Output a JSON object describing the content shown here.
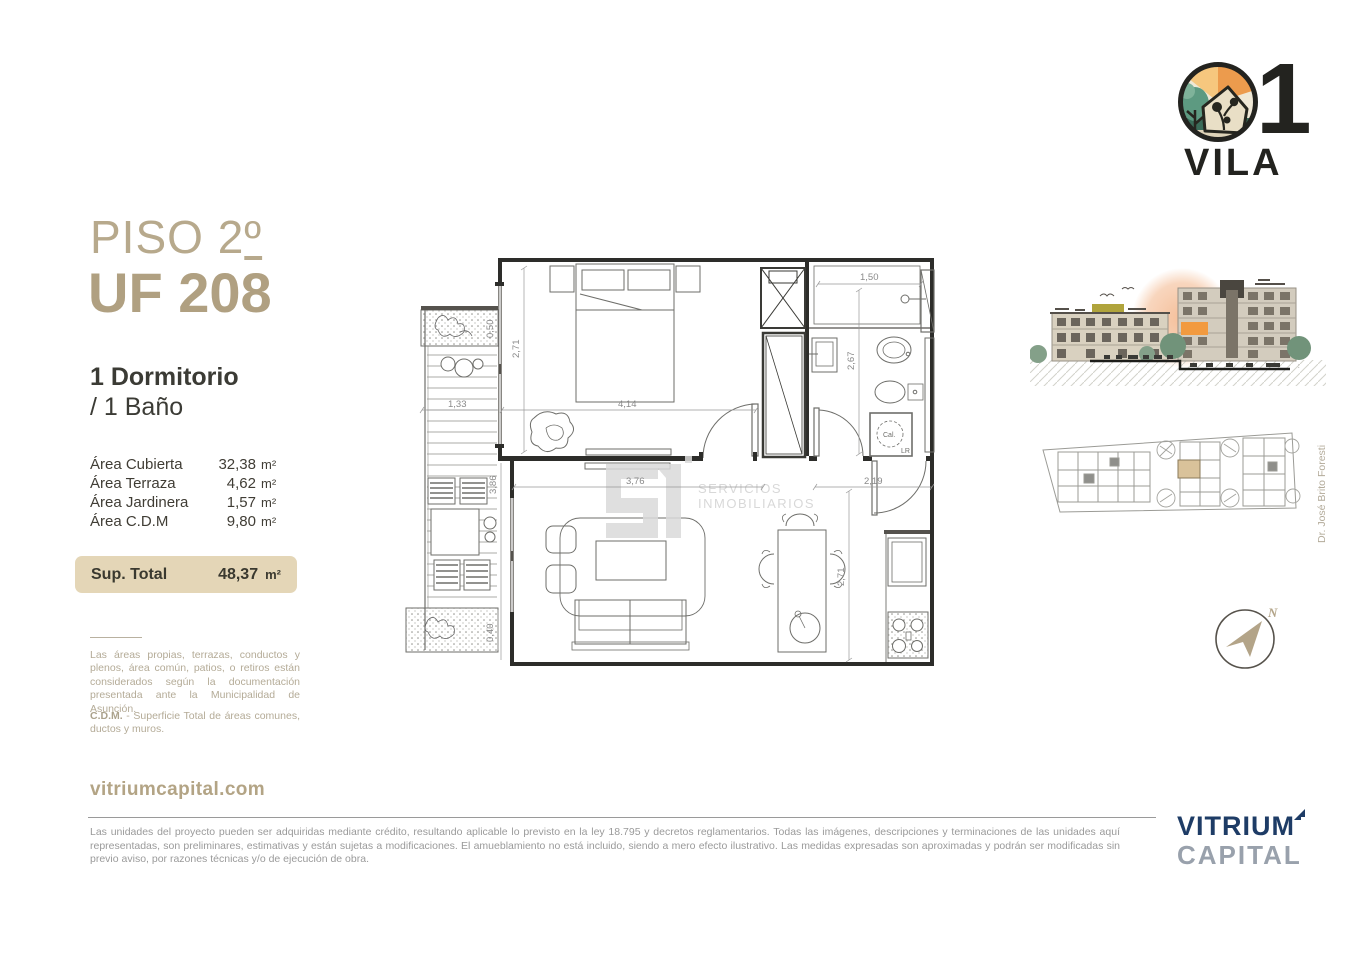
{
  "brand": {
    "number": "1",
    "name": "VILA"
  },
  "unit": {
    "floor_prefix": "PISO 2",
    "floor_ordinal": "º",
    "unit_code": "UF 208",
    "bedrooms": "1 Dormitorio",
    "bathrooms": "/ 1 Baño"
  },
  "areas": {
    "rows": [
      {
        "label": "Área Cubierta",
        "value": "32,38",
        "unit": "m²"
      },
      {
        "label": "Área Terraza",
        "value": "4,62",
        "unit": "m²"
      },
      {
        "label": "Área Jardinera",
        "value": "1,57",
        "unit": "m²"
      },
      {
        "label": "Área C.D.M",
        "value": "9,80",
        "unit": "m²"
      }
    ],
    "total_label": "Sup. Total",
    "total_value": "48,37",
    "total_unit": "m²"
  },
  "notes": {
    "general": "Las áreas propias, terrazas, conductos y plenos, área común, patios, o retiros están considerados según la documentación presentada ante la Municipalidad de Asunción.",
    "cdm_term": "C.D.M.",
    "cdm_definition": " - Superficie Total de áreas comunes, ductos y muros."
  },
  "website": "vitriumcapital.com",
  "footer": {
    "disclaimer": "Las unidades del proyecto pueden ser adquiridas mediante crédito, resultando aplicable lo previsto en la ley 18.795 y decretos reglamentarios. Todas las imágenes, descripciones y terminaciones de las unidades aquí representadas, son preliminares, estimativas y están sujetas a modificaciones. El amueblamiento no está incluido, siendo a mero efecto ilustrativo. Las medidas expresadas son aproximadas y podrán ser modificadas sin previo aviso, por razones técnicas y/o de ejecución de obra.",
    "brand_top": "VITRIUM",
    "brand_bottom": "CAPITAL"
  },
  "floorplan": {
    "dims": {
      "shower_width": "1,50",
      "bedroom_side": "2,71",
      "bath_depth": "2,67",
      "balcony_width": "1,33",
      "bedroom_width": "4,14",
      "balcony_length": "3,86",
      "planter_top": "0,50",
      "planter_bottom": "0,40",
      "living_width": "3,76",
      "entry_width": "2,19",
      "living_depth": "2,71"
    },
    "labels": {
      "heater": "Cal.",
      "laundry": "LR"
    },
    "watermark": {
      "line1": "SERVICIOS",
      "line2": "INMOBILIARIOS"
    }
  },
  "siteplan": {
    "street": "Dr. José Brito Foresti"
  },
  "compass": {
    "north": "N"
  },
  "colors": {
    "accent_tan": "#b3a284",
    "total_box": "#e4d6b7",
    "navy": "#1e3c66",
    "capital_gray": "#99a1ac",
    "note_text": "#b4ab97",
    "footer_text": "#9a9a9a",
    "highlight_unit": "#d9c29a",
    "render_orange": "#f29a3f"
  }
}
